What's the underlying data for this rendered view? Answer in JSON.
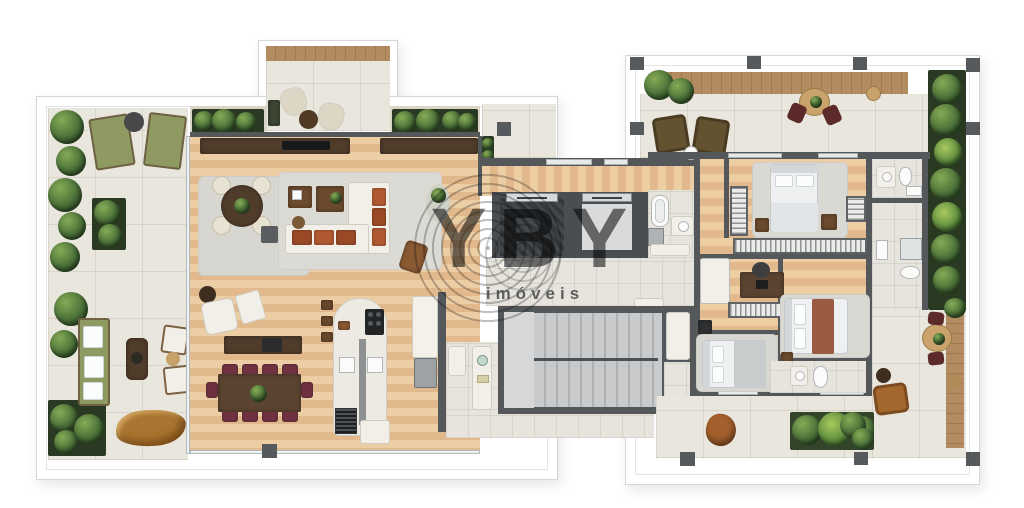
{
  "watermark": {
    "title": "YBY",
    "subtitle": "imóveis"
  },
  "palette": {
    "background": "#ffffff",
    "slab_line": "#d5d7d6",
    "wall": "#54585b",
    "wood_floor": "#e6c198",
    "deck_wood": "#ab8a60",
    "pavers": "#e9e6de",
    "tile": "#e6e4dd",
    "core_gray": "#bfc1c3",
    "rug": "#d7d6d0",
    "plant_green": "#4a7038",
    "planter_dark": "#2a3a22",
    "sofa_cushion_rust": "#b05a32",
    "dining_chair_burgundy": "#6e3140",
    "dark_wood": "#503c2a",
    "olive_outdoor": "#8f9a63",
    "bed_white": "#eef0f1",
    "blanket_rust": "#9b5a42",
    "watermark_gray": "#3a3c3f"
  },
  "plan": {
    "left_wing_spaces": [
      "wraparound-terrace",
      "front-balcony",
      "living-room",
      "dining-room",
      "kitchen",
      "service-area"
    ],
    "core_spaces": [
      "elevator-hall",
      "elevator-1",
      "elevator-2",
      "stairwell",
      "core-bathroom"
    ],
    "right_wing_spaces": [
      "upper-terrace",
      "master-bedroom",
      "bedroom-2",
      "bedroom-3",
      "bathroom-1",
      "bathroom-2",
      "bathroom-3",
      "lower-terrace"
    ]
  },
  "furniture": {
    "terrace_left": [
      "sun-lounger",
      "sun-lounger",
      "round-side-table",
      "outdoor-sofa",
      "fire-table",
      "lounge-chairs",
      "log-bench",
      "planters"
    ],
    "balcony": [
      "hanging-chair",
      "hanging-chair",
      "round-coffee-table"
    ],
    "living": [
      "sideboard",
      "round-table-4-chairs",
      "l-shaped-sofa",
      "coffee-tables",
      "ottoman-cube",
      "reading-chair",
      "plant-stand"
    ],
    "dining": [
      "armchair-with-ottoman",
      "console",
      "dining-table-10-chairs"
    ],
    "kitchen": [
      "island-with-cooktop",
      "double-sink",
      "grill",
      "service-cart",
      "tall-counter",
      "range",
      "pantry-cabinet"
    ],
    "core": [
      "elevator",
      "elevator",
      "switchback-stair",
      "bathtub",
      "vanity"
    ],
    "bedrooms": [
      "double-bed",
      "double-bed",
      "double-bed",
      "nightstands",
      "wardrobes",
      "desk-with-chair",
      "dressers"
    ],
    "bathrooms": [
      "toilet",
      "vanity",
      "shower"
    ],
    "terrace_right": [
      "wicker-chairs",
      "bistro-table",
      "round-dining-set",
      "armchair",
      "planter-boxes",
      "potted-plants"
    ]
  }
}
